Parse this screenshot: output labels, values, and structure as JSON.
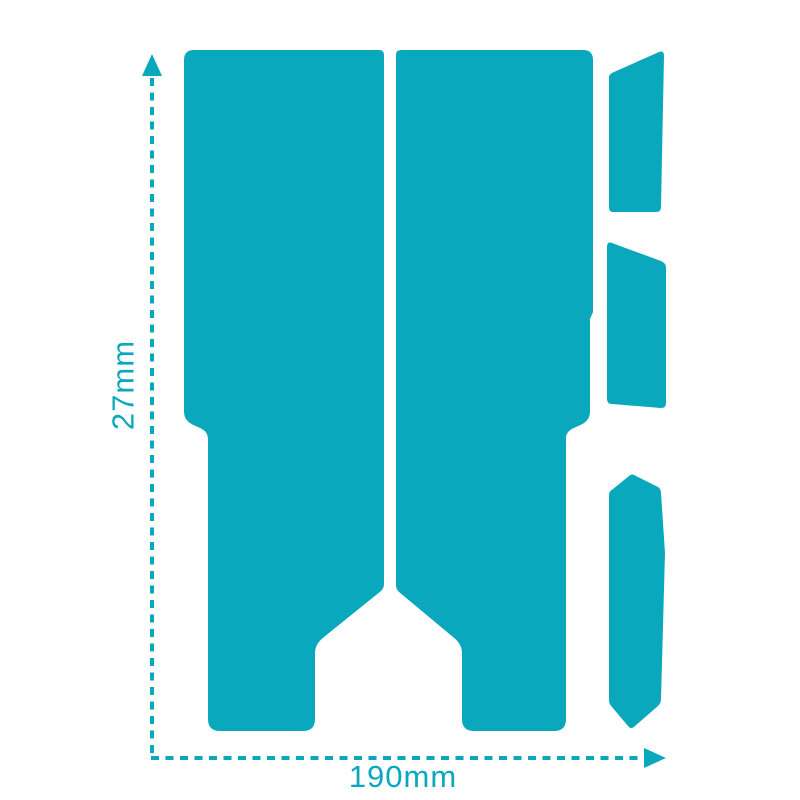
{
  "diagram": {
    "kind": "product-dimension-diagram",
    "accent_color": "#0AA8BC",
    "background_color": "#FFFFFF",
    "dimensions": {
      "height_label": "27mm",
      "width_label": "190mm"
    },
    "pieces": [
      "left-panel",
      "right-panel",
      "top-right-strip",
      "middle-right-strip",
      "bottom-right-strip"
    ]
  }
}
